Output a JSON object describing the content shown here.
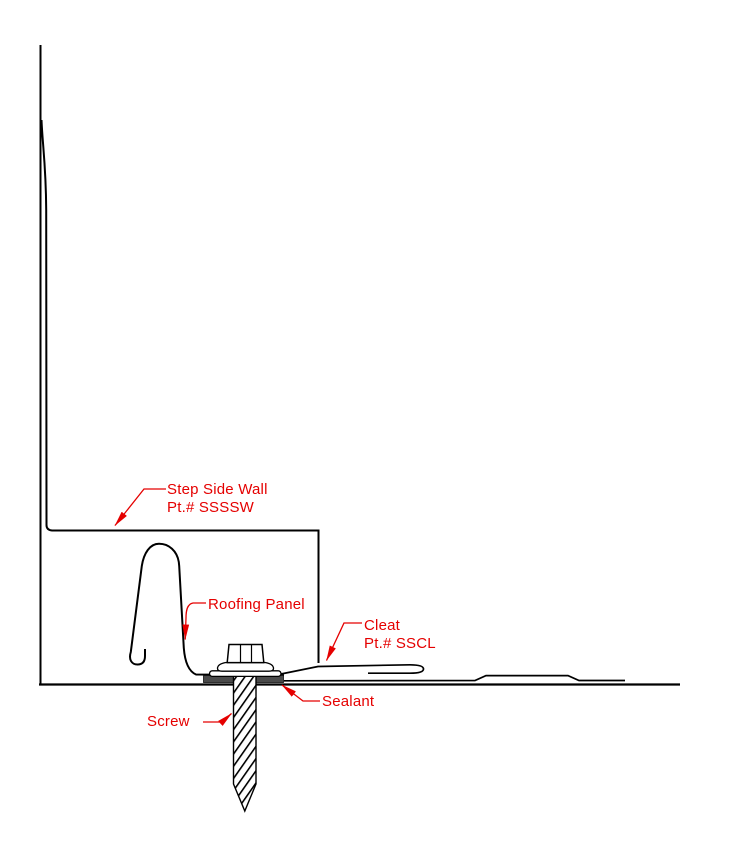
{
  "diagram": {
    "type": "construction-detail-drawing",
    "background_color": "#ffffff",
    "line_color": "#000000",
    "label_color": "#e50000",
    "sealant_fill_color": "#4a4a4a",
    "parts": {
      "step_side_wall": {
        "label_line1": "Step Side Wall",
        "label_line2": "Pt.# SSSSW"
      },
      "roofing_panel": {
        "label_line1": "Roofing Panel"
      },
      "cleat": {
        "label_line1": "Cleat",
        "label_line2": "Pt.# SSCL"
      },
      "sealant": {
        "label_line1": "Sealant"
      },
      "screw": {
        "label_line1": "Screw"
      }
    }
  }
}
